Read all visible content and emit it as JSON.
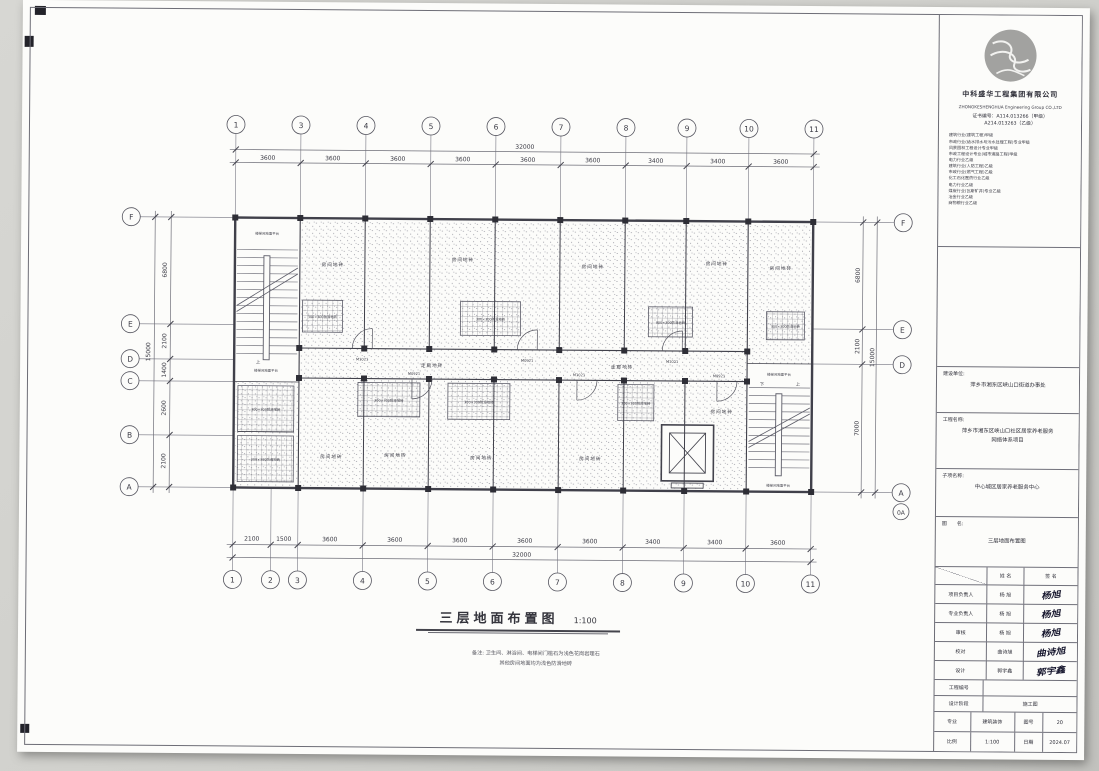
{
  "plan": {
    "title": "三层地面布置图",
    "scale": "1:100",
    "note_line1": "备注: 卫生间、淋浴间、电梯间门槛石为浅色花岗岩理石",
    "note_line2": "其他房间地面均为浅色防滑地砖",
    "grid": {
      "top_bubbles": [
        "1",
        "3",
        "4",
        "5",
        "6",
        "7",
        "8",
        "9",
        "10",
        "11"
      ],
      "bottom_bubbles": [
        "1",
        "2",
        "3",
        "4",
        "5",
        "6",
        "7",
        "8",
        "9",
        "10",
        "11"
      ],
      "left_bubbles": [
        "F",
        "E",
        "D",
        "C",
        "B",
        "A"
      ],
      "right_bubbles": [
        "F",
        "E",
        "D",
        "A",
        "0A"
      ],
      "top_dims": [
        "3600",
        "3600",
        "3600",
        "3600",
        "3600",
        "3600",
        "3400",
        "3400",
        "3600"
      ],
      "top_total": "32000",
      "bottom_dims": [
        "2100",
        "1500",
        "3600",
        "3600",
        "3600",
        "3600",
        "3600",
        "3400",
        "3400",
        "3600"
      ],
      "bottom_total": "32000",
      "left_dims": [
        "6800",
        "2100",
        "1400",
        "2600",
        "2100"
      ],
      "left_total": "15000",
      "right_dims": [
        "6800",
        "2100",
        "7000"
      ],
      "right_total": "15000"
    },
    "labels": {
      "room": "房间地砖",
      "corridor": "走廊地砖",
      "tile": "300×300防滑地砖",
      "stair": "楼梯间地面平台",
      "up": "上",
      "down": "下"
    },
    "door_tags": [
      "M1021",
      "M0921",
      "M1021",
      "M0921",
      "M1021",
      "M0921"
    ]
  },
  "titleblock": {
    "company_cn": "中科盛华工程集团有限公司",
    "company_en": "ZHONGKESHENGHUA Engineering Group CO.,LTD",
    "cert_line1": "证书编号：A114.013266（甲级）",
    "cert_line2": "A214.013263（乙级）",
    "qualifications": [
      "建筑行业(建筑工程)甲级",
      "市政行业(给水排水与污水处理工程)专业甲级",
      "风景园林工程设计专业甲级",
      "市政工程设计专业(城市道路工程)甲级",
      "电力行业乙级",
      "建筑行业(人防工程)乙级",
      "市政行业(燃气工程)乙级",
      "化工石化医药行业乙级",
      "电力行业乙级",
      "煤炭行业(瓦斯矿井)专业乙级",
      "冶金行业乙级",
      "商物粮行业乙级"
    ],
    "client_label": "建设单位:",
    "client": "萍乡市湘东区峡山口街道办事处",
    "project_label": "工程名称:",
    "project_line1": "萍乡市湘东区峡山口社区居家养老服务",
    "project_line2": "网络体系项目",
    "subitem_label": "子项名称:",
    "subitem": "中心城区居家养老服务中心",
    "drawing_label": "图　　名:",
    "drawing": "三层地面布置图",
    "table": {
      "col_name": "姓  名",
      "col_sign": "签  名",
      "rows": [
        {
          "role": "项目负责人",
          "name": "杨  旭",
          "sign": "杨旭"
        },
        {
          "role": "专业负责人",
          "name": "杨  旭",
          "sign": "杨旭"
        },
        {
          "role": "审核",
          "name": "杨  旭",
          "sign": "杨旭"
        },
        {
          "role": "校对",
          "name": "曲诗旭",
          "sign": "曲诗旭"
        },
        {
          "role": "设计",
          "name": "郭宇鑫",
          "sign": "郭宇鑫"
        }
      ]
    },
    "project_no_label": "工程编号",
    "project_no": "",
    "stage_label": "设计阶段",
    "stage": "施工图",
    "major_label": "专业",
    "major": "建筑装饰",
    "fig_label": "图号",
    "fig": "20",
    "scale_label": "比例",
    "scale": "1:100",
    "date_label": "日期",
    "date": "2024.07"
  }
}
